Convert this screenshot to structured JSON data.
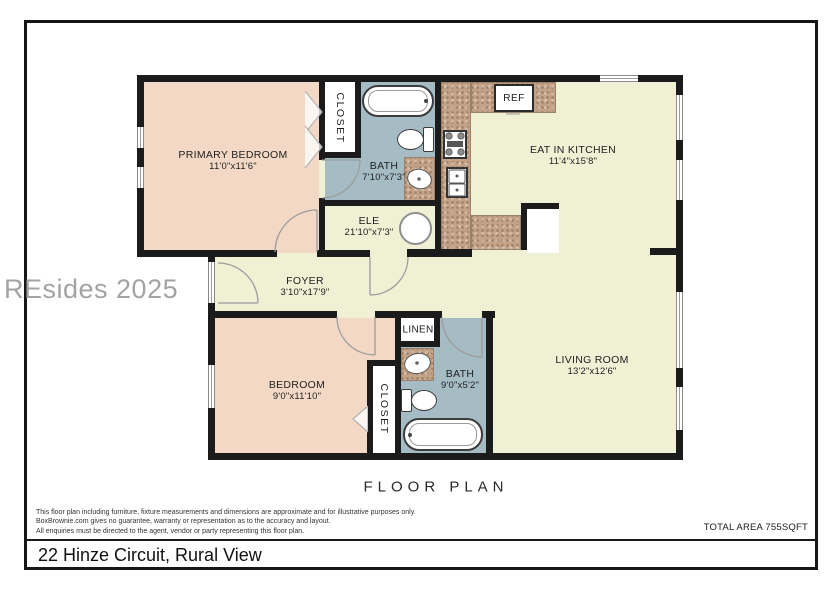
{
  "meta": {
    "plan_heading": "FLOOR PLAN",
    "address": "22 Hinze Circuit, Rural View",
    "total_area": "TOTAL AREA 755SQFT",
    "watermark": "REsides 2025"
  },
  "disclaimer": {
    "line1": "This floor plan including furniture, fixture measurements and dimensions are approximate and for illustrative purposes only.",
    "line2": "BoxBrownie.com gives no guarantee, warranty or representation as to the accuracy and layout.",
    "line3": "All enquiries must be directed to the agent, vendor or party representing this floor plan."
  },
  "rooms": {
    "primary_bedroom": {
      "name": "PRIMARY BEDROOM",
      "dims": "11'0\"x11'6\""
    },
    "closet1": {
      "name": "CLOSET"
    },
    "bath1": {
      "name": "BATH",
      "dims": "7'10\"x7'3\""
    },
    "ele": {
      "name": "ELE",
      "dims": "21'10\"x7'3\""
    },
    "kitchen": {
      "name": "EAT IN KITCHEN",
      "dims": "11'4\"x15'8\""
    },
    "foyer": {
      "name": "FOYER",
      "dims": "3'10\"x17'9\""
    },
    "living": {
      "name": "LIVING ROOM",
      "dims": "13'2\"x12'6\""
    },
    "bedroom2": {
      "name": "BEDROOM",
      "dims": "9'0\"x11'10\""
    },
    "closet2": {
      "name": "CLOSET"
    },
    "linen": {
      "name": "LINEN"
    },
    "bath2": {
      "name": "BATH",
      "dims": "9'0\"x5'2\""
    },
    "ref": {
      "name": "REF"
    }
  },
  "colors": {
    "wall": "#1b1b1b",
    "floor_main": "#eff0d4",
    "floor_bedroom": "#f3d9c5",
    "floor_bath": "#a5bcc5",
    "counter": "#c3a287"
  }
}
